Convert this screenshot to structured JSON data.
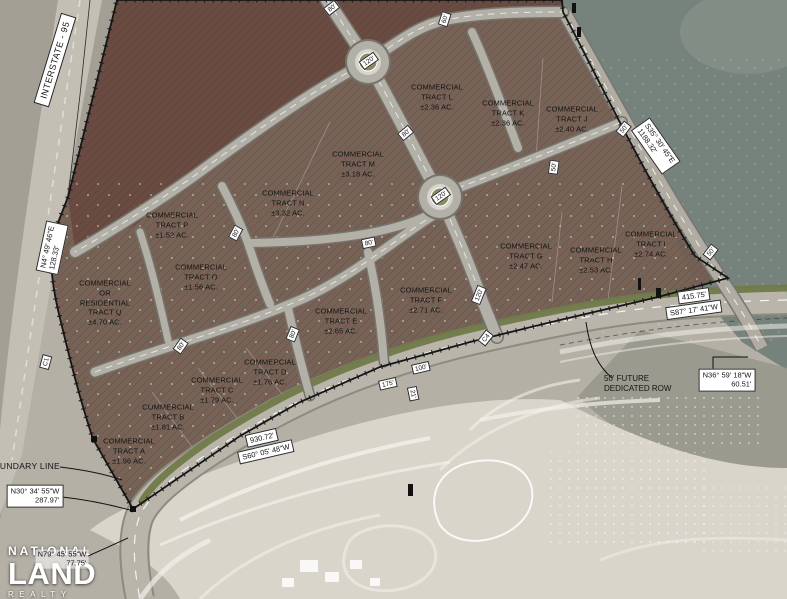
{
  "title": "Commercial tracts site plan",
  "logo": {
    "top": "NATIONAL",
    "middle": "LAND",
    "bottom": "REALTY"
  },
  "tracts": [
    {
      "id": "L",
      "text": "COMMERCIAL\nTRACT L\n±2.36 AC."
    },
    {
      "id": "K",
      "text": "COMMERCIAL\nTRACT K\n±2.36 AC."
    },
    {
      "id": "J",
      "text": "COMMERCIAL\nTRACT J\n±2.40 AC."
    },
    {
      "id": "M",
      "text": "COMMERCIAL\nTRACT M\n±3.18 AC."
    },
    {
      "id": "N",
      "text": "COMMERCIAL\nTRACT N\n±3.32 AC."
    },
    {
      "id": "P",
      "text": "COMMERCIAL\nTRACT P\n±1.52 AC."
    },
    {
      "id": "O",
      "text": "COMMERCIAL\nTRACT O\n±1.56 AC."
    },
    {
      "id": "Q",
      "text": "COMMERCIAL\nOR\nRESIDENTIAL\nTRACT Q\n±4.70 AC."
    },
    {
      "id": "I",
      "text": "COMMERCIAL\nTRACT I\n±2.74 AC."
    },
    {
      "id": "H",
      "text": "COMMERCIAL\nTRACT H\n±2.53 AC."
    },
    {
      "id": "G",
      "text": "COMMERCIAL\nTRACT G\n±2.47 AC."
    },
    {
      "id": "F",
      "text": "COMMERCIAL\nTRACT F\n±2.71 AC."
    },
    {
      "id": "E",
      "text": "COMMERCIAL\nTRACT E\n±2.65 AC."
    },
    {
      "id": "D",
      "text": "COMMERCIAL\nTRACT D\n±1.76 AC."
    },
    {
      "id": "C",
      "text": "COMMERCIAL\nTRACT C\n±1.79 AC."
    },
    {
      "id": "B",
      "text": "COMMERCIAL\nTRACT B\n±1.81 AC."
    },
    {
      "id": "A",
      "text": "COMMERCIAL\nTRACT A\n±1.96 AC."
    }
  ],
  "road_labels": [
    "80'",
    "60'",
    "120'",
    "80'",
    "120'",
    "80'",
    "80'",
    "80'",
    "80'",
    "120'",
    "50'",
    "50'",
    "50'",
    "175'",
    "100'",
    "21'",
    "C1",
    "C4"
  ],
  "bearings": {
    "interstate": "INTERSTATE - 95",
    "west": {
      "bearing": "N4° 49' 46\"E",
      "distance": "128.33'"
    },
    "northeast": {
      "bearing": "S35° 30' 45\"E",
      "distance": "1188.32'"
    },
    "southeast": {
      "distance": "415.75'",
      "bearing": "S87° 17' 41\"W"
    },
    "east_corner": {
      "bearing": "N36° 59' 18\"W",
      "distance": "60.51'"
    },
    "south": {
      "distance": "930.72'",
      "bearing": "S60° 05' 48\"W"
    },
    "southwest": {
      "bearing": "N30° 34' 55\"W",
      "distance": "287.97'"
    },
    "south_tip": {
      "bearing": "N79° 45' 55\"W",
      "distance": "77.75'"
    },
    "row_note": "50' FUTURE\nDEDICATED ROW",
    "boundary_note": "BOUNDARY LINE"
  },
  "colors": {
    "water": "#76827c",
    "land": "#b4b0a6",
    "parcel_fill": "#6e6156",
    "hatch": "#a33d2b",
    "road": "#b3b0a8",
    "green_strip": "#6f7a48"
  }
}
